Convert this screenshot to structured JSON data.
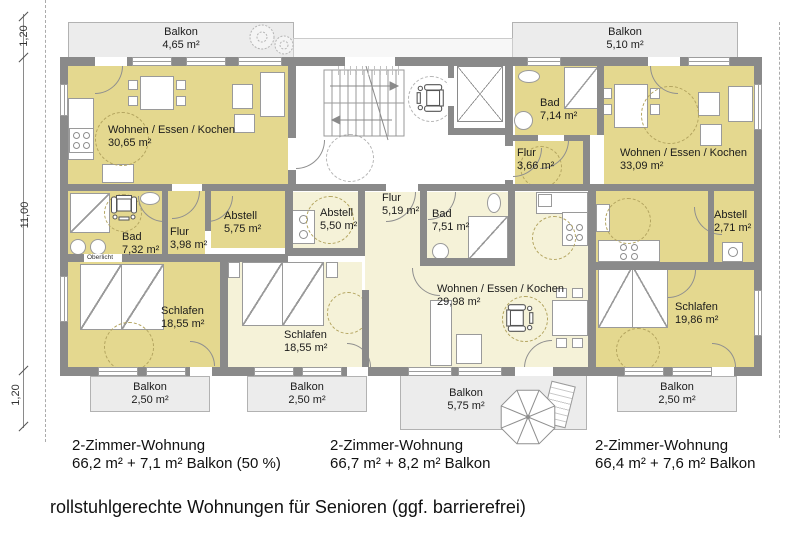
{
  "caption": "rollstuhlgerechte Wohnungen für Senioren (ggf. barrierefrei)",
  "dimensions": {
    "top": "1,20",
    "middle": "11,00",
    "bottom": "1,20"
  },
  "balconies": {
    "top_left": {
      "name": "Balkon",
      "area": "4,65 m²"
    },
    "top_right": {
      "name": "Balkon",
      "area": "5,10 m²"
    },
    "bottom_left": {
      "name": "Balkon",
      "area": "2,50 m²"
    },
    "bottom_mid_left": {
      "name": "Balkon",
      "area": "2,50 m²"
    },
    "bottom_mid_big": {
      "name": "Balkon",
      "area": "5,75 m²"
    },
    "bottom_right": {
      "name": "Balkon",
      "area": "2,50 m²"
    }
  },
  "rooms": {
    "l_living": {
      "name": "Wohnen / Essen / Kochen",
      "area": "30,65 m²"
    },
    "l_bad": {
      "name": "Bad",
      "area": "7,32 m²"
    },
    "l_flur": {
      "name": "Flur",
      "area": "3,98 m²"
    },
    "l_abstell": {
      "name": "Abstell",
      "area": "5,75 m²"
    },
    "l_schlafen": {
      "name": "Schlafen",
      "area": "18,55 m²"
    },
    "oberlicht": "Oberlicht",
    "m_abstell": {
      "name": "Abstell",
      "area": "5,50 m²"
    },
    "m_flur": {
      "name": "Flur",
      "area": "5,19 m²"
    },
    "m_bad": {
      "name": "Bad",
      "area": "7,51 m²"
    },
    "m_living": {
      "name": "Wohnen / Essen / Kochen",
      "area": "29,98 m²"
    },
    "m_schlafen": {
      "name": "Schlafen",
      "area": "18,55 m²"
    },
    "r_bad": {
      "name": "Bad",
      "area": "7,14 m²"
    },
    "r_flur": {
      "name": "Flur",
      "area": "3,66 m²"
    },
    "r_living": {
      "name": "Wohnen / Essen / Kochen",
      "area": "33,09 m²"
    },
    "r_abstell": {
      "name": "Abstell",
      "area": "2,71 m²"
    },
    "r_schlafen": {
      "name": "Schlafen",
      "area": "19,86 m²"
    }
  },
  "apartments": [
    {
      "title": "2-Zimmer-Wohnung",
      "detail": "66,2 m² + 7,1 m² Balkon (50 %)"
    },
    {
      "title": "2-Zimmer-Wohnung",
      "detail": "66,7 m² + 8,2 m² Balkon"
    },
    {
      "title": "2-Zimmer-Wohnung",
      "detail": "66,4 m² + 7,6 m² Balkon"
    }
  ],
  "icons": {
    "wheelchair": "wheelchair-top-view",
    "umbrella": "parasol-top-view",
    "bush": "shrub-plan-symbol",
    "elevator": "elevator-crossed-box",
    "stairs": "staircase-with-direction-arrows"
  },
  "colors": {
    "apartment_dark": "#e4d88f",
    "apartment_light": "#f5f2d8",
    "balcony": "#ececec",
    "wall": "#8a8a8a"
  }
}
